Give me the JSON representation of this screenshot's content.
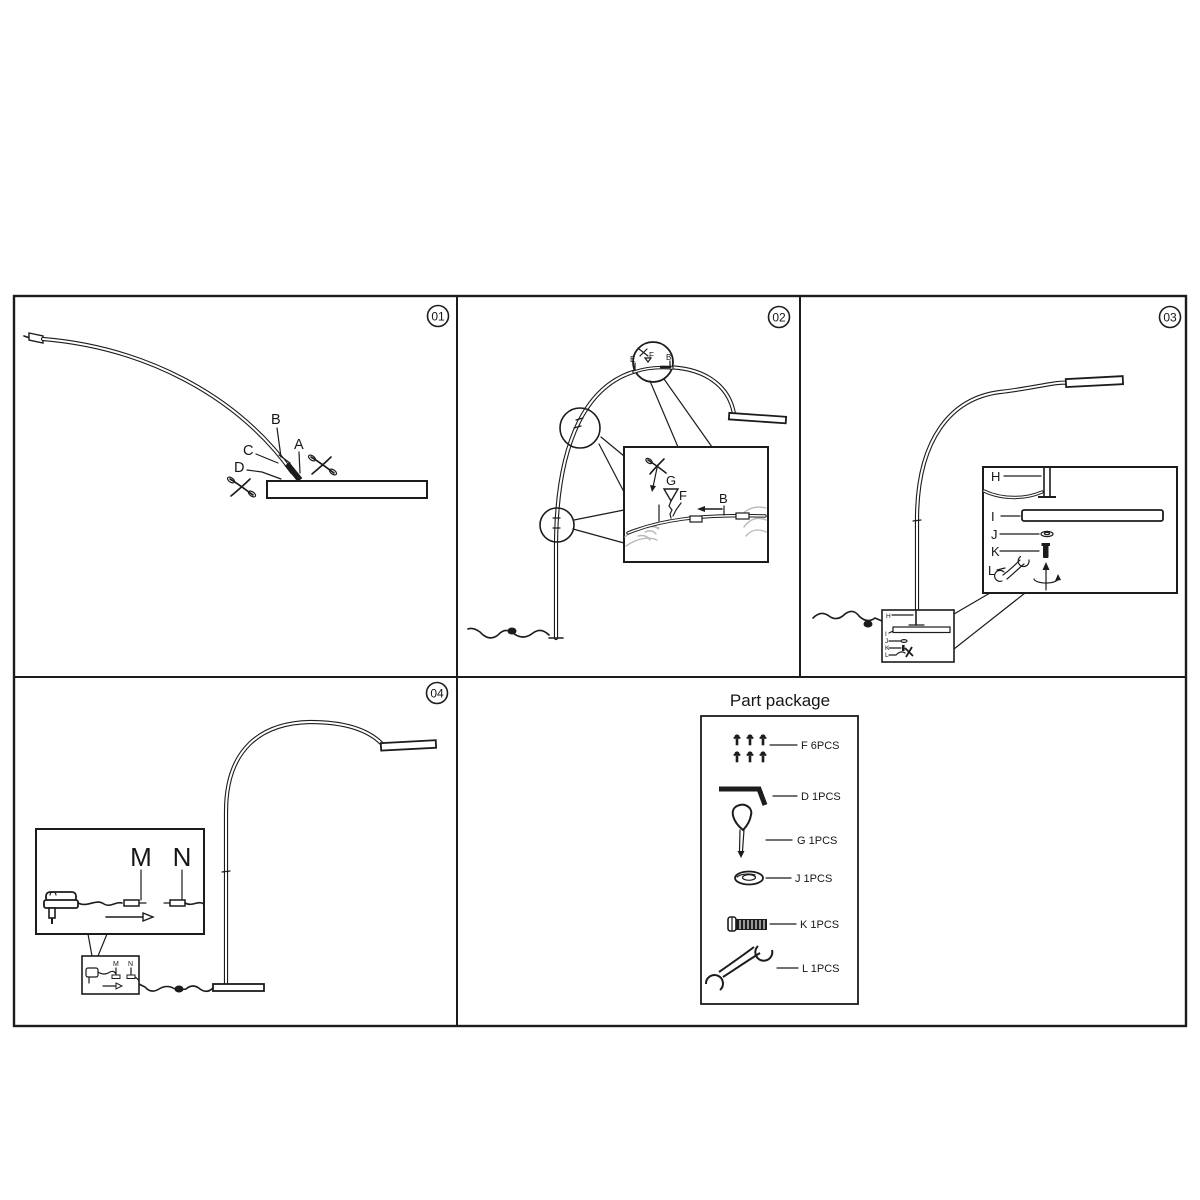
{
  "p1": {
    "num": "01",
    "a": "A",
    "b": "B",
    "c": "C",
    "d": "D"
  },
  "p2": {
    "num": "02",
    "e": "E",
    "f": "F",
    "b": "B",
    "g": "G",
    "f2": "F",
    "b2": "B"
  },
  "p3": {
    "num": "03",
    "h": "H",
    "i": "I",
    "j": "J",
    "k": "K",
    "l": "L",
    "mh": "H",
    "mi": "I",
    "mj": "J",
    "mk": "K",
    "ml": "L"
  },
  "p4": {
    "num": "04",
    "m": "M",
    "n": "N",
    "mm": "M",
    "mn": "N"
  },
  "pp": {
    "title": "Part package",
    "items": [
      {
        "part": "F",
        "icon": "screw-set-icon",
        "label": "F  6PCS"
      },
      {
        "part": "D",
        "icon": "allen-key-icon",
        "label": "D  1PCS"
      },
      {
        "part": "G",
        "icon": "pin-tool-icon",
        "label": "G  1PCS"
      },
      {
        "part": "J",
        "icon": "washer-icon",
        "label": "J  1PCS"
      },
      {
        "part": "K",
        "icon": "bolt-icon",
        "label": "K  1PCS"
      },
      {
        "part": "L",
        "icon": "wrench-icon",
        "label": "L  1PCS"
      }
    ]
  },
  "colors": {
    "line": "#1c1c1c",
    "hand_outline": "#b9b9b9",
    "background": "#ffffff"
  }
}
